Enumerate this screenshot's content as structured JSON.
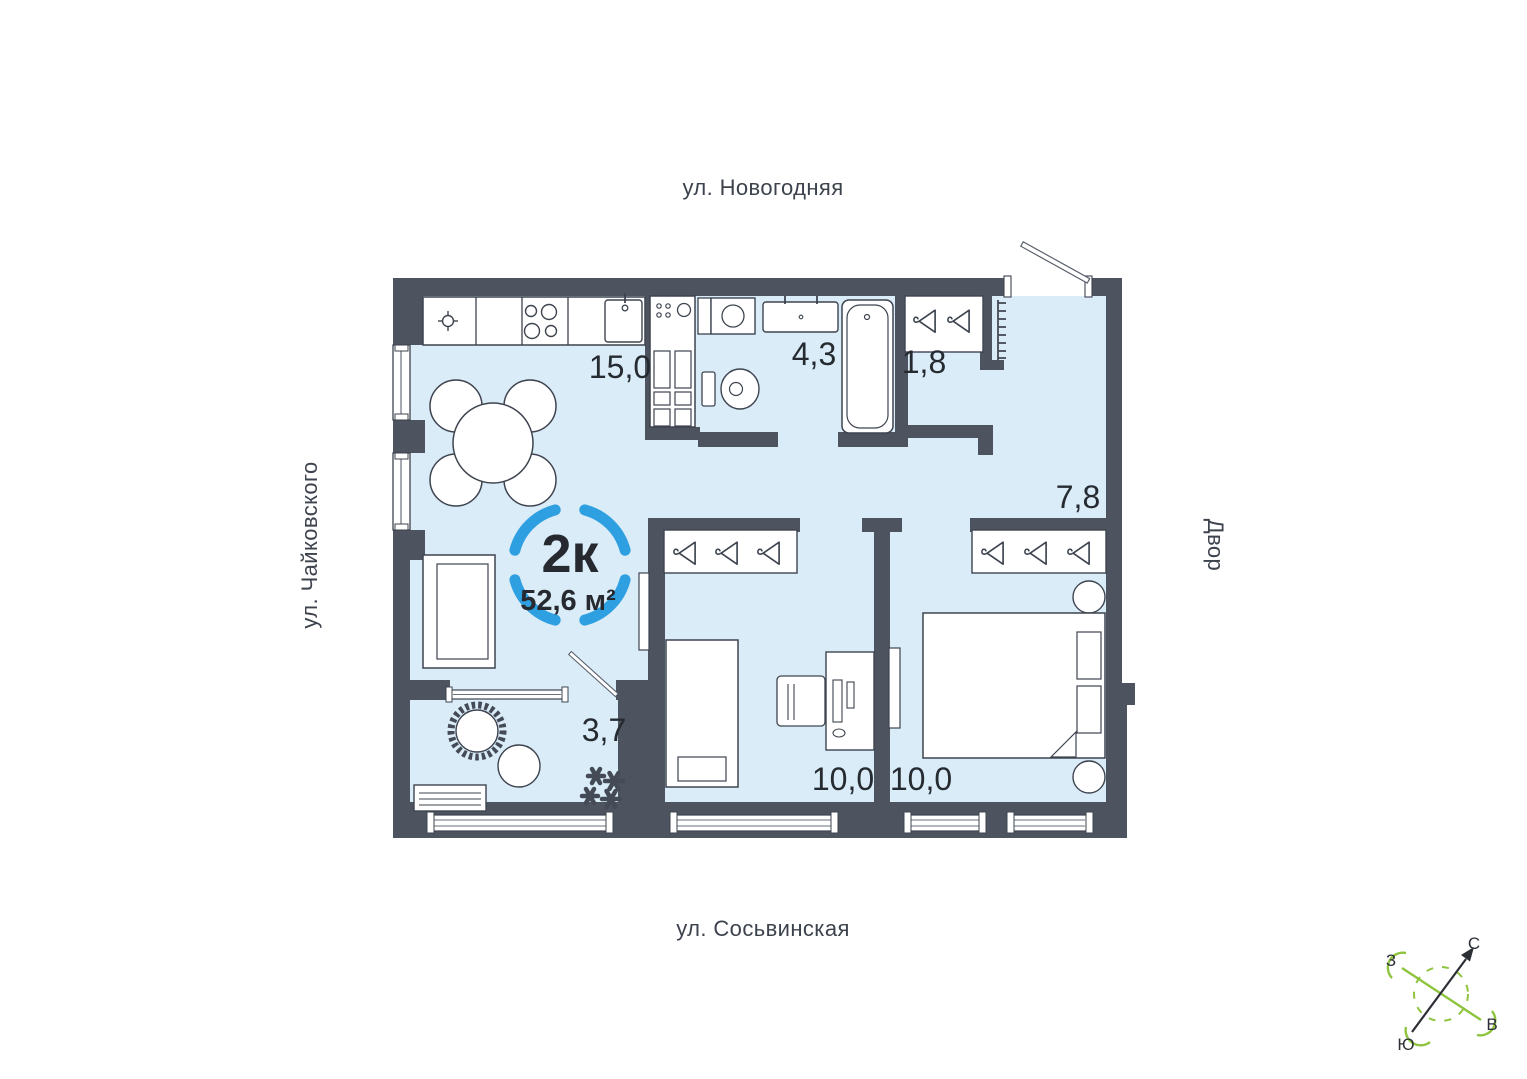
{
  "unit": {
    "type_label": "2к",
    "area_label": "52,6 м²"
  },
  "rooms": {
    "kitchen_living": "15,0",
    "bathroom": "4,3",
    "closet": "1,8",
    "hallway": "7,8",
    "loggia": "3,7",
    "bedroom_1": "10,0",
    "bedroom_2": "10,0"
  },
  "streets": {
    "top": "ул. Новогодняя",
    "left": "ул. Чайковского",
    "bottom": "ул. Сосьвинская",
    "right": "Двор"
  },
  "compass": {
    "north": "С",
    "south": "Ю",
    "west": "З",
    "east": "В"
  },
  "colors": {
    "wall": "#4d535f",
    "floor": "#d9ecf8",
    "accent_blue": "#2e9fe0",
    "compass_green": "#8fc43f",
    "line": "#3e444f",
    "text_dark": "#262a31",
    "street_text": "#3d434d"
  }
}
